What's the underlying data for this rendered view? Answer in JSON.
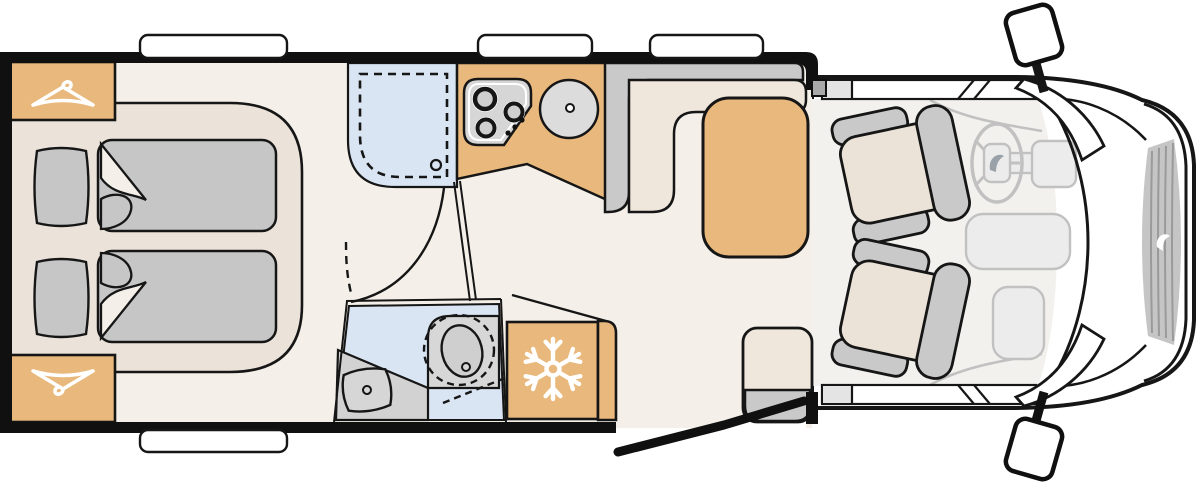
{
  "document_title": "Camper van floor plan, top view",
  "palette": {
    "background": "#ffffff",
    "outline": "#161616",
    "wall": "#101010",
    "floor": "#f4f0e9",
    "cab_floor": "#f2f1ee",
    "bed_base": "#ebe3d9",
    "seat_cream": "#efe7db",
    "cab_seat_cream": "#ece3d8",
    "fabric_gray": "#c6c6c6",
    "furniture_gray": "#c9c9c9",
    "appliance_gray": "#d7d7d7",
    "stove_gray": "#d6d6d6",
    "bowl_gray": "#cfcfcf",
    "wet_blue": "#dae5f3",
    "wood_tan": "#e9b87c",
    "cab_line": "#c1c1c1",
    "dash_fill": "#ececec",
    "grille_gray": "#c5c5c5",
    "grille_line": "#9a9a9a",
    "pillar_gray": "#a9a9a9",
    "logo_gray": "#9aa1a8",
    "white": "#ffffff"
  },
  "icons": {
    "wardrobe_rear": "clothes-hanger-icon",
    "wardrobe_front": "clothes-hanger-icon-inverted",
    "fridge": "snowflake-icon",
    "steering_hub": "brand-drop-logo",
    "grille_badge": "brand-drop-logo"
  },
  "areas": {
    "bedroom": "rear-twin-beds-with-pillows-and-duvets",
    "wardrobe_count": 2,
    "shower": "shower-cubicle-with-dashed-tray",
    "washroom": "washroom-with-swivel-basin-and-toilet",
    "kitchen": "kitchen-block-with-3-burner-hob-and-round-sink",
    "fridge": "refrigerator",
    "dinette": "l-shaped-bench-with-table",
    "travel_seat": "single-travel-seat-at-entry",
    "cab": "driver-cab-with-two-swivel-seats-steering-wheel",
    "entry_door": "open-entry-door",
    "window_count_top": 3,
    "window_count_bottom": 1,
    "mirror_count": 2
  }
}
